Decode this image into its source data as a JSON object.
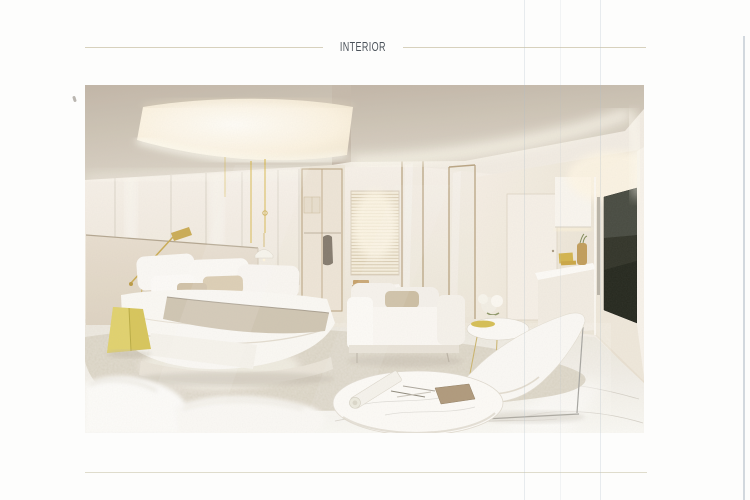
{
  "page": {
    "header": {
      "title": "INTERIOR",
      "text_color": "#4b525a",
      "rule_color": "#d7d1bd"
    },
    "artwork": {
      "kind": "architectural rendering of a luxury bedroom suite",
      "microtext_left": "*········· ······· ········",
      "microtext_right": "····· ········",
      "colors": {
        "accent_yellow": "#d6c455",
        "brass": "#c9a94e",
        "ceiling_beige": "#c8beb0",
        "cove_glow": "#fdf6e4",
        "wall_white": "#f3eee5",
        "rug_beige": "#d7d0c1",
        "tv_screen": "#272b20",
        "wood_chair": "#c59f66",
        "floor_marble": "#f7f4ef"
      },
      "objects": [
        "tray-ceiling-cove",
        "mirror-wall",
        "wardrobe",
        "window-blinds",
        "desk",
        "wooden-chair",
        "glass-partition",
        "door",
        "floating-cabinet",
        "counter-decor",
        "tv-screen",
        "bed",
        "headboard",
        "pillows",
        "yellow-stool",
        "brass-wall-lamp",
        "pendant-light",
        "sofa",
        "coffee-table",
        "flower-vase",
        "lounge-chair",
        "rug",
        "marble-coffee-table",
        "rolled-drawing",
        "pencils",
        "notebook"
      ]
    }
  }
}
